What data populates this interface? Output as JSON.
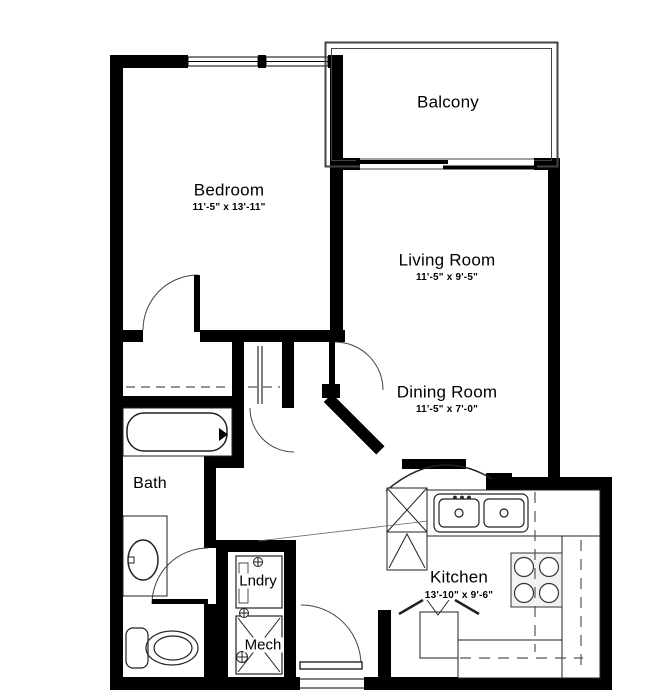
{
  "plan": {
    "background": "#ffffff",
    "wall_color": "#000000",
    "line_color": "#1a1a1a",
    "rooms": {
      "bedroom": {
        "name": "Bedroom",
        "dims": "11'-5\" x 13'-11\""
      },
      "balcony": {
        "name": "Balcony"
      },
      "living_room": {
        "name": "Living Room",
        "dims": "11'-5\" x 9'-5\""
      },
      "dining_room": {
        "name": "Dining Room",
        "dims": "11'-5\" x 7'-0\""
      },
      "kitchen": {
        "name": "Kitchen",
        "dims": "13'-10\" x 9'-6\""
      },
      "bath": {
        "name": "Bath"
      },
      "laundry": {
        "name": "Lndry"
      },
      "mech": {
        "name": "Mech"
      }
    },
    "fixtures": [
      "bathtub",
      "vanity-sink",
      "toilet",
      "washer",
      "mechanical-unit",
      "refrigerator",
      "tall-cabinet",
      "double-basin-sink",
      "range-stove",
      "bifold-pantry",
      "closet-shelf",
      "sliding-glass-door",
      "entry-door",
      "bedroom-windows",
      "balcony-railing"
    ]
  }
}
